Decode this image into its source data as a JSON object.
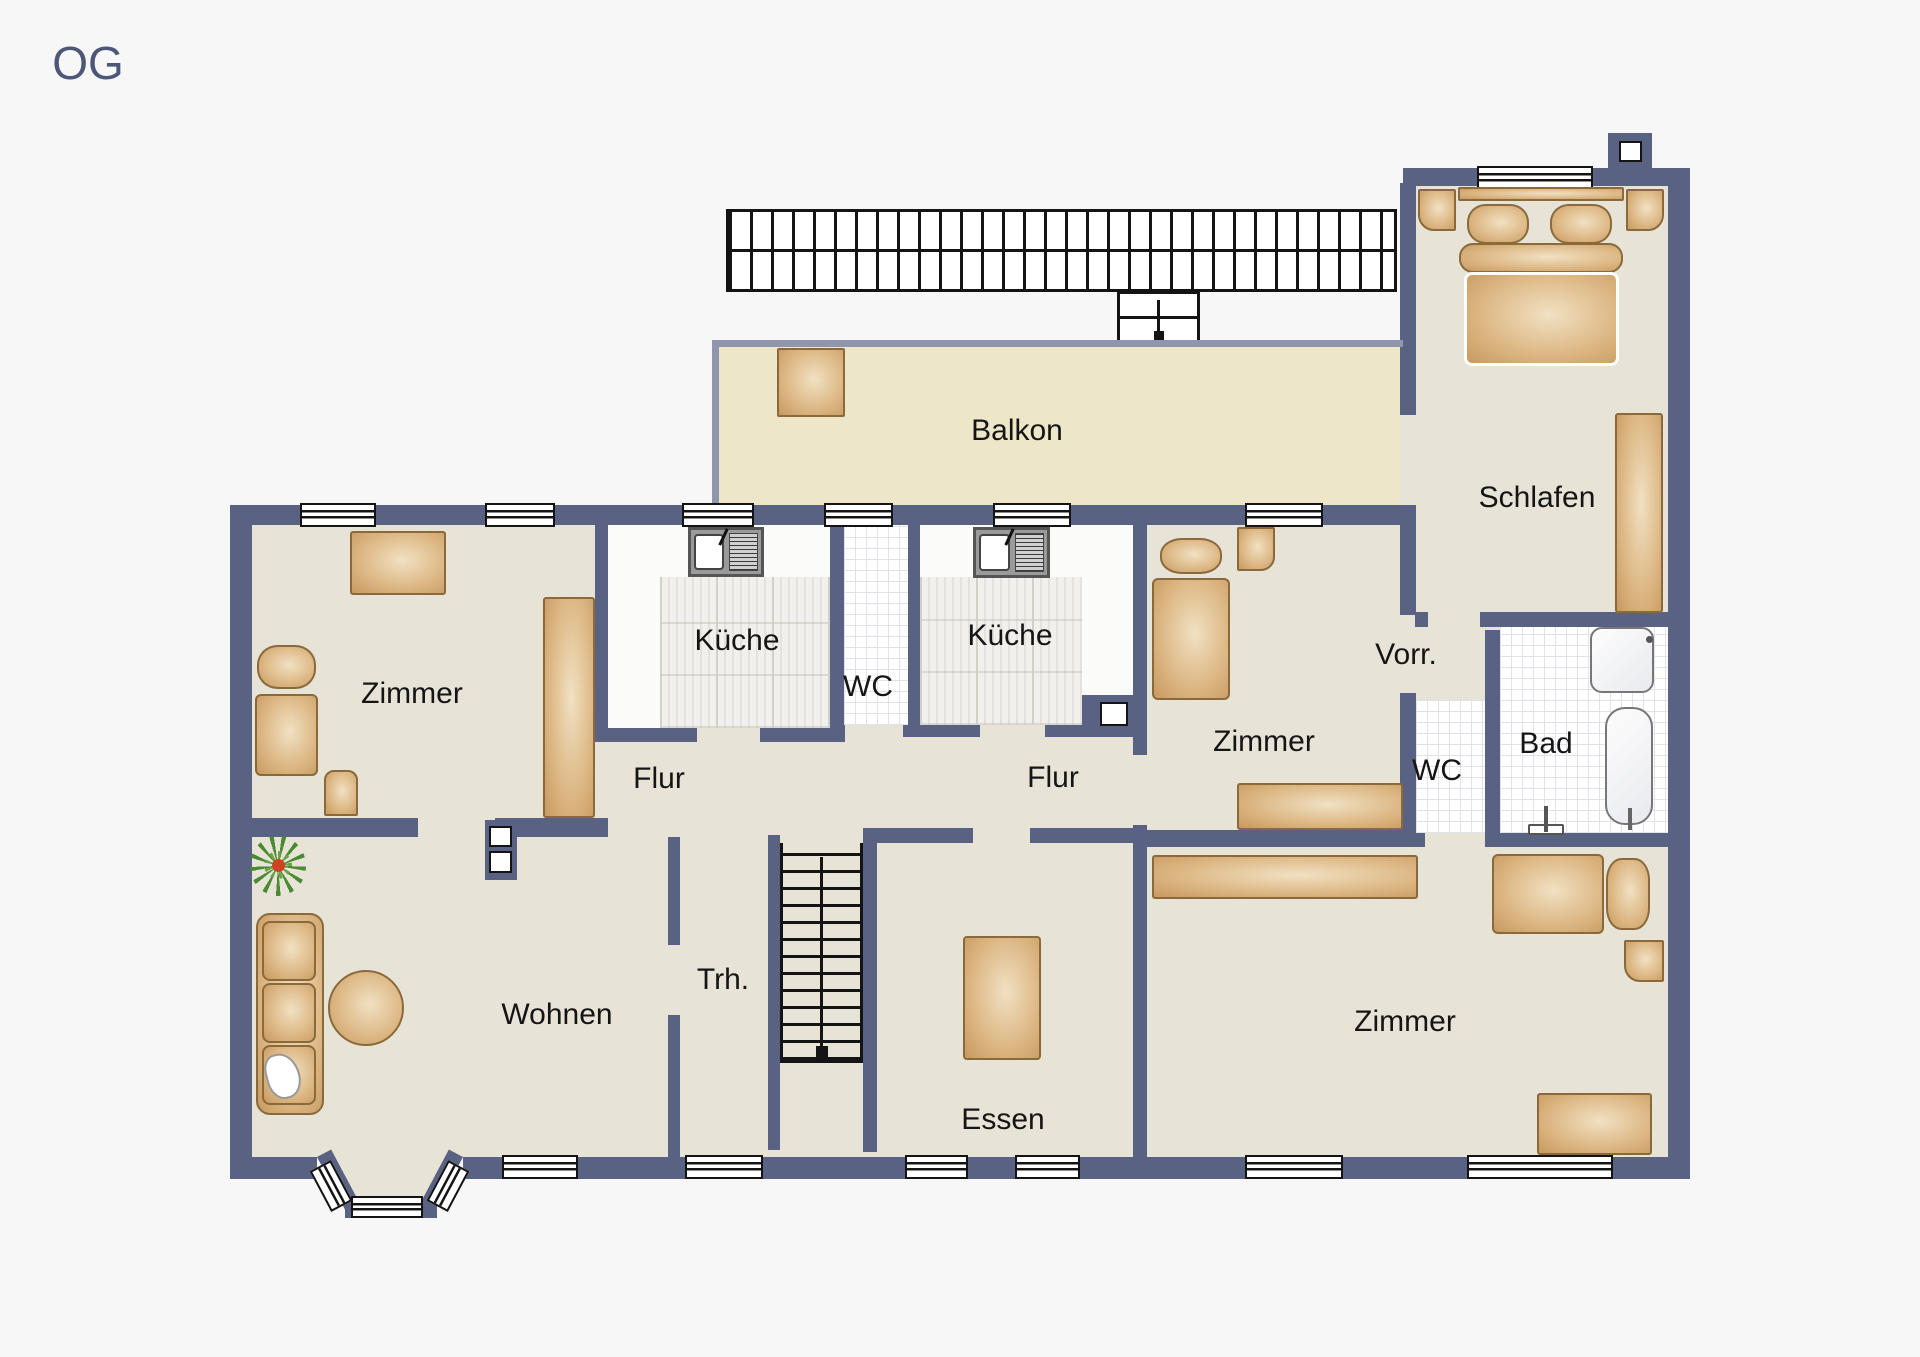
{
  "title": {
    "floor_label": "OG"
  },
  "labels": {
    "balkon": "Balkon",
    "schlafen": "Schlafen",
    "zimmer_nw": "Zimmer",
    "kueche_west": "Küche",
    "wc_mid": "WC",
    "kueche_east": "Küche",
    "zimmer_mid": "Zimmer",
    "vorraum": "Vorr.",
    "wc_east": "WC",
    "bad": "Bad",
    "flur_west": "Flur",
    "flur_east": "Flur",
    "treppenhaus": "Trh.",
    "wohnen": "Wohnen",
    "essen": "Essen",
    "zimmer_se": "Zimmer"
  },
  "colors": {
    "bg": "#f7f7f7",
    "wall": "#5a6284",
    "wall_light": "#9096ad",
    "floor": "#e7e3d6",
    "balcony_floor": "#ede6c8",
    "tile_grid": "#e2e3ea",
    "furniture_wood": "#d9ab72",
    "furniture_border": "#8a6a3a",
    "line": "#141414",
    "og_color": "#4d5878"
  }
}
